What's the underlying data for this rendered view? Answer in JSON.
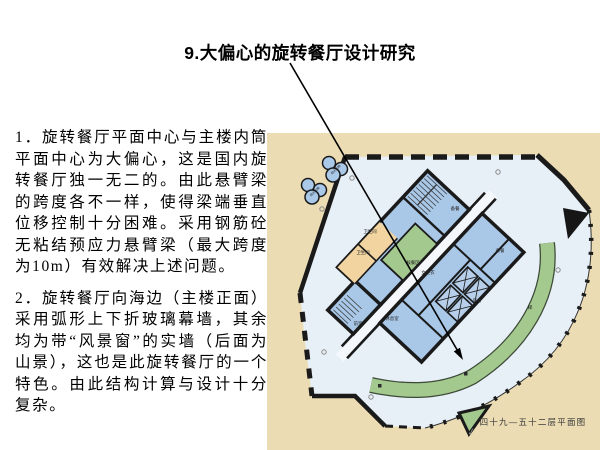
{
  "title": "9.大偏心的旋转餐厅设计研究",
  "body": {
    "p1": "1．旋转餐厅平面中心与主楼内筒平面中心为大偏心，这是国内旋转餐厅独一无二的。由此悬臂梁的跨度各不一样，使得梁端垂直位移控制十分困难。采用钢筋砼无粘结预应力悬臂梁（最大跨度为10m）有效解决上述问题。",
    "p2": "2．旋转餐厅向海边（主楼正面）采用弧形上下折玻璃幕墙，其余均为带“风景窗”的实墙（后面为山景），这也是此旋转餐厅的一个特色。由此结构计算与设计十分复杂。"
  },
  "plan": {
    "caption": "四十九—五十二层平面图",
    "pen_mark": "✓",
    "labels": {
      "restroom_upper": "卫生间",
      "restroom_lower": "卫生间",
      "waiting_area": "候餐区",
      "pantry_top": "备餐",
      "pantry_right": "备餐",
      "anteroom": "前室",
      "women_changing": "女更衣",
      "lounge": "休息室",
      "service_room": "房务",
      "stair_band": "梯",
      "sightseeing_elevator_1": "观光电梯",
      "sightseeing_elevator_2": "观光电梯"
    },
    "colors": {
      "paper": "#ecdcb4",
      "floor": "#e7eff7",
      "corridor": "#f4f8fc",
      "room_blue": "#a9c7e6",
      "shaft_blue": "#b7cfea",
      "room_orange": "#f2d4a0",
      "room_green": "#a3c98f",
      "wall": "#1a1a1a"
    }
  }
}
